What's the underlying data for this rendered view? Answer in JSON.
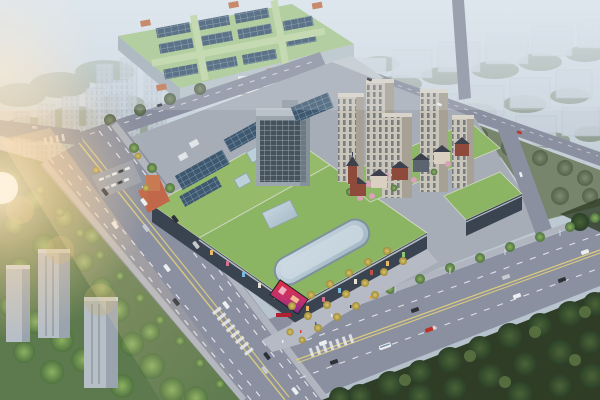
{
  "scene": {
    "title": "Aerial rendering of a mixed-use commercial development",
    "description": "Bird's-eye architectural rendering: a green-roofed shopping mall with rooftop solar panels and a curved glass skylight, a mid-rise office tower, five beige residential towers on a landscaped podium, a European-style pitched-roof retail street, a large green-roofed industrial hall to the north, hazy apartment slabs in the distance, tree-lined boulevards crossing at a major intersection, dense woodland to the southeast, and warm sunlight flaring from the west.",
    "elements": {
      "sky": "Hazy pale sky and atmosphere",
      "distant_city_nw": "Rows of hazy apartment slabs to the northwest",
      "distant_city_ne": "Hazy residential blocks and tree belts to the northeast",
      "factory": "Large green-roofed industrial hall with rooftop skylight rows and orange accents",
      "annex": "White banded annex building and service wing south of the hall",
      "mall": "Shopping mall with landscaped green roof, solar arrays, skylights and curved glass atrium",
      "office_tower": "Mid-rise office tower on the mall's north edge",
      "residential": "Cluster of five beige residential towers on a green podium with blossom trees",
      "retail_street": "European-style pitched-roof retail street with clock tower",
      "east_podium": "Green-roofed retail podium at the east corner",
      "boulevard_sw": "Wide tree-lined boulevard along the southwest frontage",
      "boulevard_se": "Boulevard along the southeast frontage",
      "north_road": "Tree-lined road along the northwest edge of the site",
      "back_road": "Distant arterial road behind the development",
      "intersection": "Major road intersection at the south corner",
      "forest": "Dense dark woodland across the southeast boulevard",
      "west_greenery": "Sunlit trees and apartment towers west of the boulevard",
      "plaza": "Entrance plaza with rows of golden ginkgo trees",
      "parking": "Surface parking bay with parked cars at the west entrance",
      "led_screen": "LED advertising screen on the mall's south corner",
      "sun_flare": "Warm sunlight flare from the west"
    }
  },
  "palette": {
    "skyTop": "#cad5dd",
    "skyBottom": "#b2bfc9",
    "hazeCity": "#c3ccd6",
    "hazeCityShade": "#a9b4c1",
    "mutedTreeBase": "#76856c",
    "factoryRoof": "#a8c78e",
    "factoryWall": "#b6c2ca",
    "factoryWallShade": "#a3afb8",
    "solarPanel": "#3e5870",
    "accentOrange": "#c0744e",
    "siteGround": "#a7adb6",
    "roadFill": "#8b90a0",
    "sidewalk": "#b0b5bf",
    "laneWhite": "#e9ebef",
    "laneYellow": "#d9c97e",
    "mallRoof": "#94ba6a",
    "mallRoofSouth": "#8bb562",
    "mallFacade": "#3a4450",
    "facadeTrim": "#b3bac4",
    "glassSkylight": "#bcd0da",
    "entranceOrange": "#c2684a",
    "whiteSlab": "#e2e7ea",
    "extensionRoof": "#c2cad0",
    "officeTower": "#9aa5ad",
    "officeTowerTop": "#b9c2c8",
    "resTowerLight": "#c9c5ba",
    "resTowerShade": "#a6a095",
    "retailRoof": "#3c414d",
    "retailBrick": "#8e4a3a",
    "retailCream": "#d9d0c1",
    "retailSlate": "#5c6470",
    "podiumGreen": "#8fb768",
    "treeBright": "#7ba24f",
    "forestBase": "#2f3d26",
    "ginkgo": "#c9b45a",
    "pinkTree": "#d8a2b8",
    "carWhite": "#eceef0",
    "carDark": "#2e3238",
    "carRed": "#c03028",
    "carSilver": "#c6cad0",
    "ledRed": "#d42f3e",
    "signRed": "#b02030",
    "flareWarm": "#ffd9a4"
  }
}
